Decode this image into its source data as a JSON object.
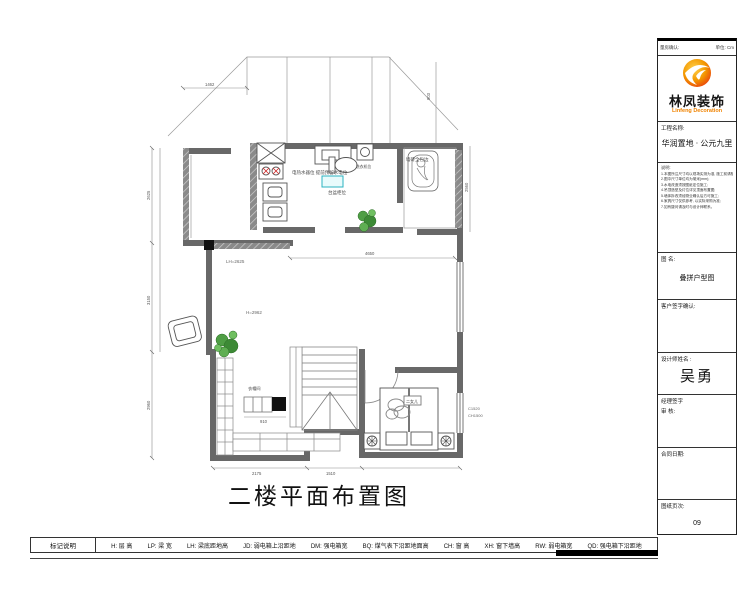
{
  "title_block": {
    "header_left": "量房确认:",
    "header_right": "单位: Cm",
    "logo": {
      "company_cn": "林凤装饰",
      "company_en": "Linfeng Decoration"
    },
    "project_label": "工程名称:",
    "project_name": "华润置地 · 公元九里",
    "notes_title": "说明:",
    "notes": [
      "1.本图所注尺寸均以现场实测为准, 施工前请核实;",
      "2.图中尺寸单位均为毫米(mm);",
      "3.水电改造须按图纸定位施工;",
      "4.吊顶造型及灯位详见顶面布置图;",
      "5.墙体拆改须经物业确认后方可施工;",
      "6.家具尺寸仅供参考, 以实际采购为准;",
      "7.如有疑问请及时与设计师联系。"
    ],
    "drawing_name_label": "图 名:",
    "drawing_name": "叠拼户型图",
    "customer_sign_label": "客户签字确认:",
    "designer_label": "设计师姓名 :",
    "designer_name": "吴勇",
    "manager_sign_label": "经理签字",
    "review_label": "审  核:",
    "contract_date_label": "合同日期:",
    "page_label": "图纸页次:",
    "page_number": "09"
  },
  "plan": {
    "title": "二楼平面布置图",
    "labels": {
      "water_heater_note": "电热水器位 提前预留水电位",
      "basin_note": "台盆柜位",
      "washer_note": "洗衣机位",
      "bath_note": "墙砖全包边",
      "room_height": "H=2962",
      "beam_note": "LH=2625",
      "bedroom_label": "二女儿",
      "closet_label": "衣帽间",
      "window_note_1": "C1520",
      "window_note_2": "CH1500"
    },
    "dims": {
      "top": "1462",
      "top_right": "903",
      "block": "2625",
      "left_upper": "2625",
      "left_mid": "3150",
      "left_lower": "2960",
      "center": "4650",
      "bottom_left": "2175",
      "bottom_mid": "1510",
      "right": "2560",
      "steps": "910"
    },
    "colors": {
      "wall": "#686868",
      "plant": "#3d8a36",
      "highlight_teal": "#2bb3c0",
      "stove_red": "#cc2222",
      "logo_orange": "#f08300",
      "logo_red": "#e8380d"
    }
  },
  "legend": {
    "label": "标记说明",
    "items": [
      "H: 层  高",
      "LP: 梁  宽",
      "LH: 梁底距地高",
      "JD: 弱电箱上沿距地",
      "DM: 强电箱宽",
      "BQ: 煤气表下沿距地面高",
      "CH: 窗  高",
      "XH: 窗下墙高",
      "RW: 弱电箱宽",
      "QD: 强电箱下沿距地"
    ]
  }
}
